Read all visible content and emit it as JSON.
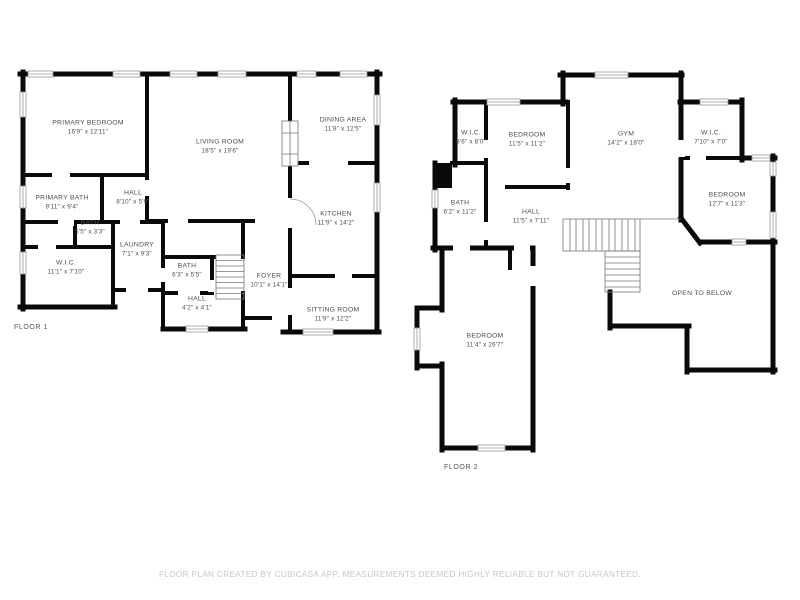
{
  "colors": {
    "wall": "#0a0a0a",
    "label_text": "#4d4d4d",
    "footer_text": "#c7c7c7"
  },
  "footer": {
    "text": "FLOOR PLAN CREATED BY CUBICASA APP. MEASUREMENTS DEEMED HIGHLY RELIABLE BUT NOT GUARANTEED."
  },
  "floors": [
    {
      "label": "FLOOR 1",
      "rooms": [
        {
          "name": "PRIMARY BEDROOM",
          "dims": "16'9\" x 12'11\"",
          "x": 88,
          "y": 128
        },
        {
          "name": "LIVING ROOM",
          "dims": "18'5\" x 19'6\"",
          "x": 220,
          "y": 147
        },
        {
          "name": "DINING AREA",
          "dims": "11'8\" x 12'5\"",
          "x": 343,
          "y": 125
        },
        {
          "name": "HALL",
          "dims": "8'10\" x 5'9\"",
          "x": 133,
          "y": 198
        },
        {
          "name": "PRIMARY BATH",
          "dims": "9'11\" x 9'4\"",
          "x": 62,
          "y": 203
        },
        {
          "name": "BATH",
          "dims": "5'5\" x 3'3\"",
          "x": 90,
          "y": 228
        },
        {
          "name": "LAUNDRY",
          "dims": "7'1\" x 9'3\"",
          "x": 137,
          "y": 250
        },
        {
          "name": "W.I.C.",
          "dims": "11'1\" x 7'10\"",
          "x": 66,
          "y": 268
        },
        {
          "name": "KITCHEN",
          "dims": "11'9\" x 14'2\"",
          "x": 336,
          "y": 219
        },
        {
          "name": "BATH",
          "dims": "6'3\" x 5'5\"",
          "x": 187,
          "y": 271
        },
        {
          "name": "FOYER",
          "dims": "10'1\" x 14'1\"",
          "x": 269,
          "y": 281
        },
        {
          "name": "HALL",
          "dims": "4'2\" x 4'1\"",
          "x": 197,
          "y": 304
        },
        {
          "name": "SITTING ROOM",
          "dims": "11'9\" x 12'2\"",
          "x": 333,
          "y": 315
        }
      ]
    },
    {
      "label": "FLOOR 2",
      "rooms": [
        {
          "name": "W.I.C.",
          "dims": "3'6\" x 8'0\"",
          "x": 471,
          "y": 138
        },
        {
          "name": "BEDROOM",
          "dims": "11'5\" x 11'2\"",
          "x": 527,
          "y": 140
        },
        {
          "name": "GYM",
          "dims": "14'2\" x 18'0\"",
          "x": 626,
          "y": 139
        },
        {
          "name": "W.I.C.",
          "dims": "7'10\" x 7'0\"",
          "x": 711,
          "y": 138
        },
        {
          "name": "BATH",
          "dims": "6'2\" x 11'2\"",
          "x": 460,
          "y": 208
        },
        {
          "name": "HALL",
          "dims": "11'5\" x 7'11\"",
          "x": 531,
          "y": 217
        },
        {
          "name": "BEDROOM",
          "dims": "12'7\" x 11'3\"",
          "x": 727,
          "y": 200
        },
        {
          "name": "OPEN TO BELOW",
          "dims": "",
          "x": 702,
          "y": 294
        },
        {
          "name": "BEDROOM",
          "dims": "11'4\" x 26'7\"",
          "x": 485,
          "y": 341
        }
      ]
    }
  ]
}
